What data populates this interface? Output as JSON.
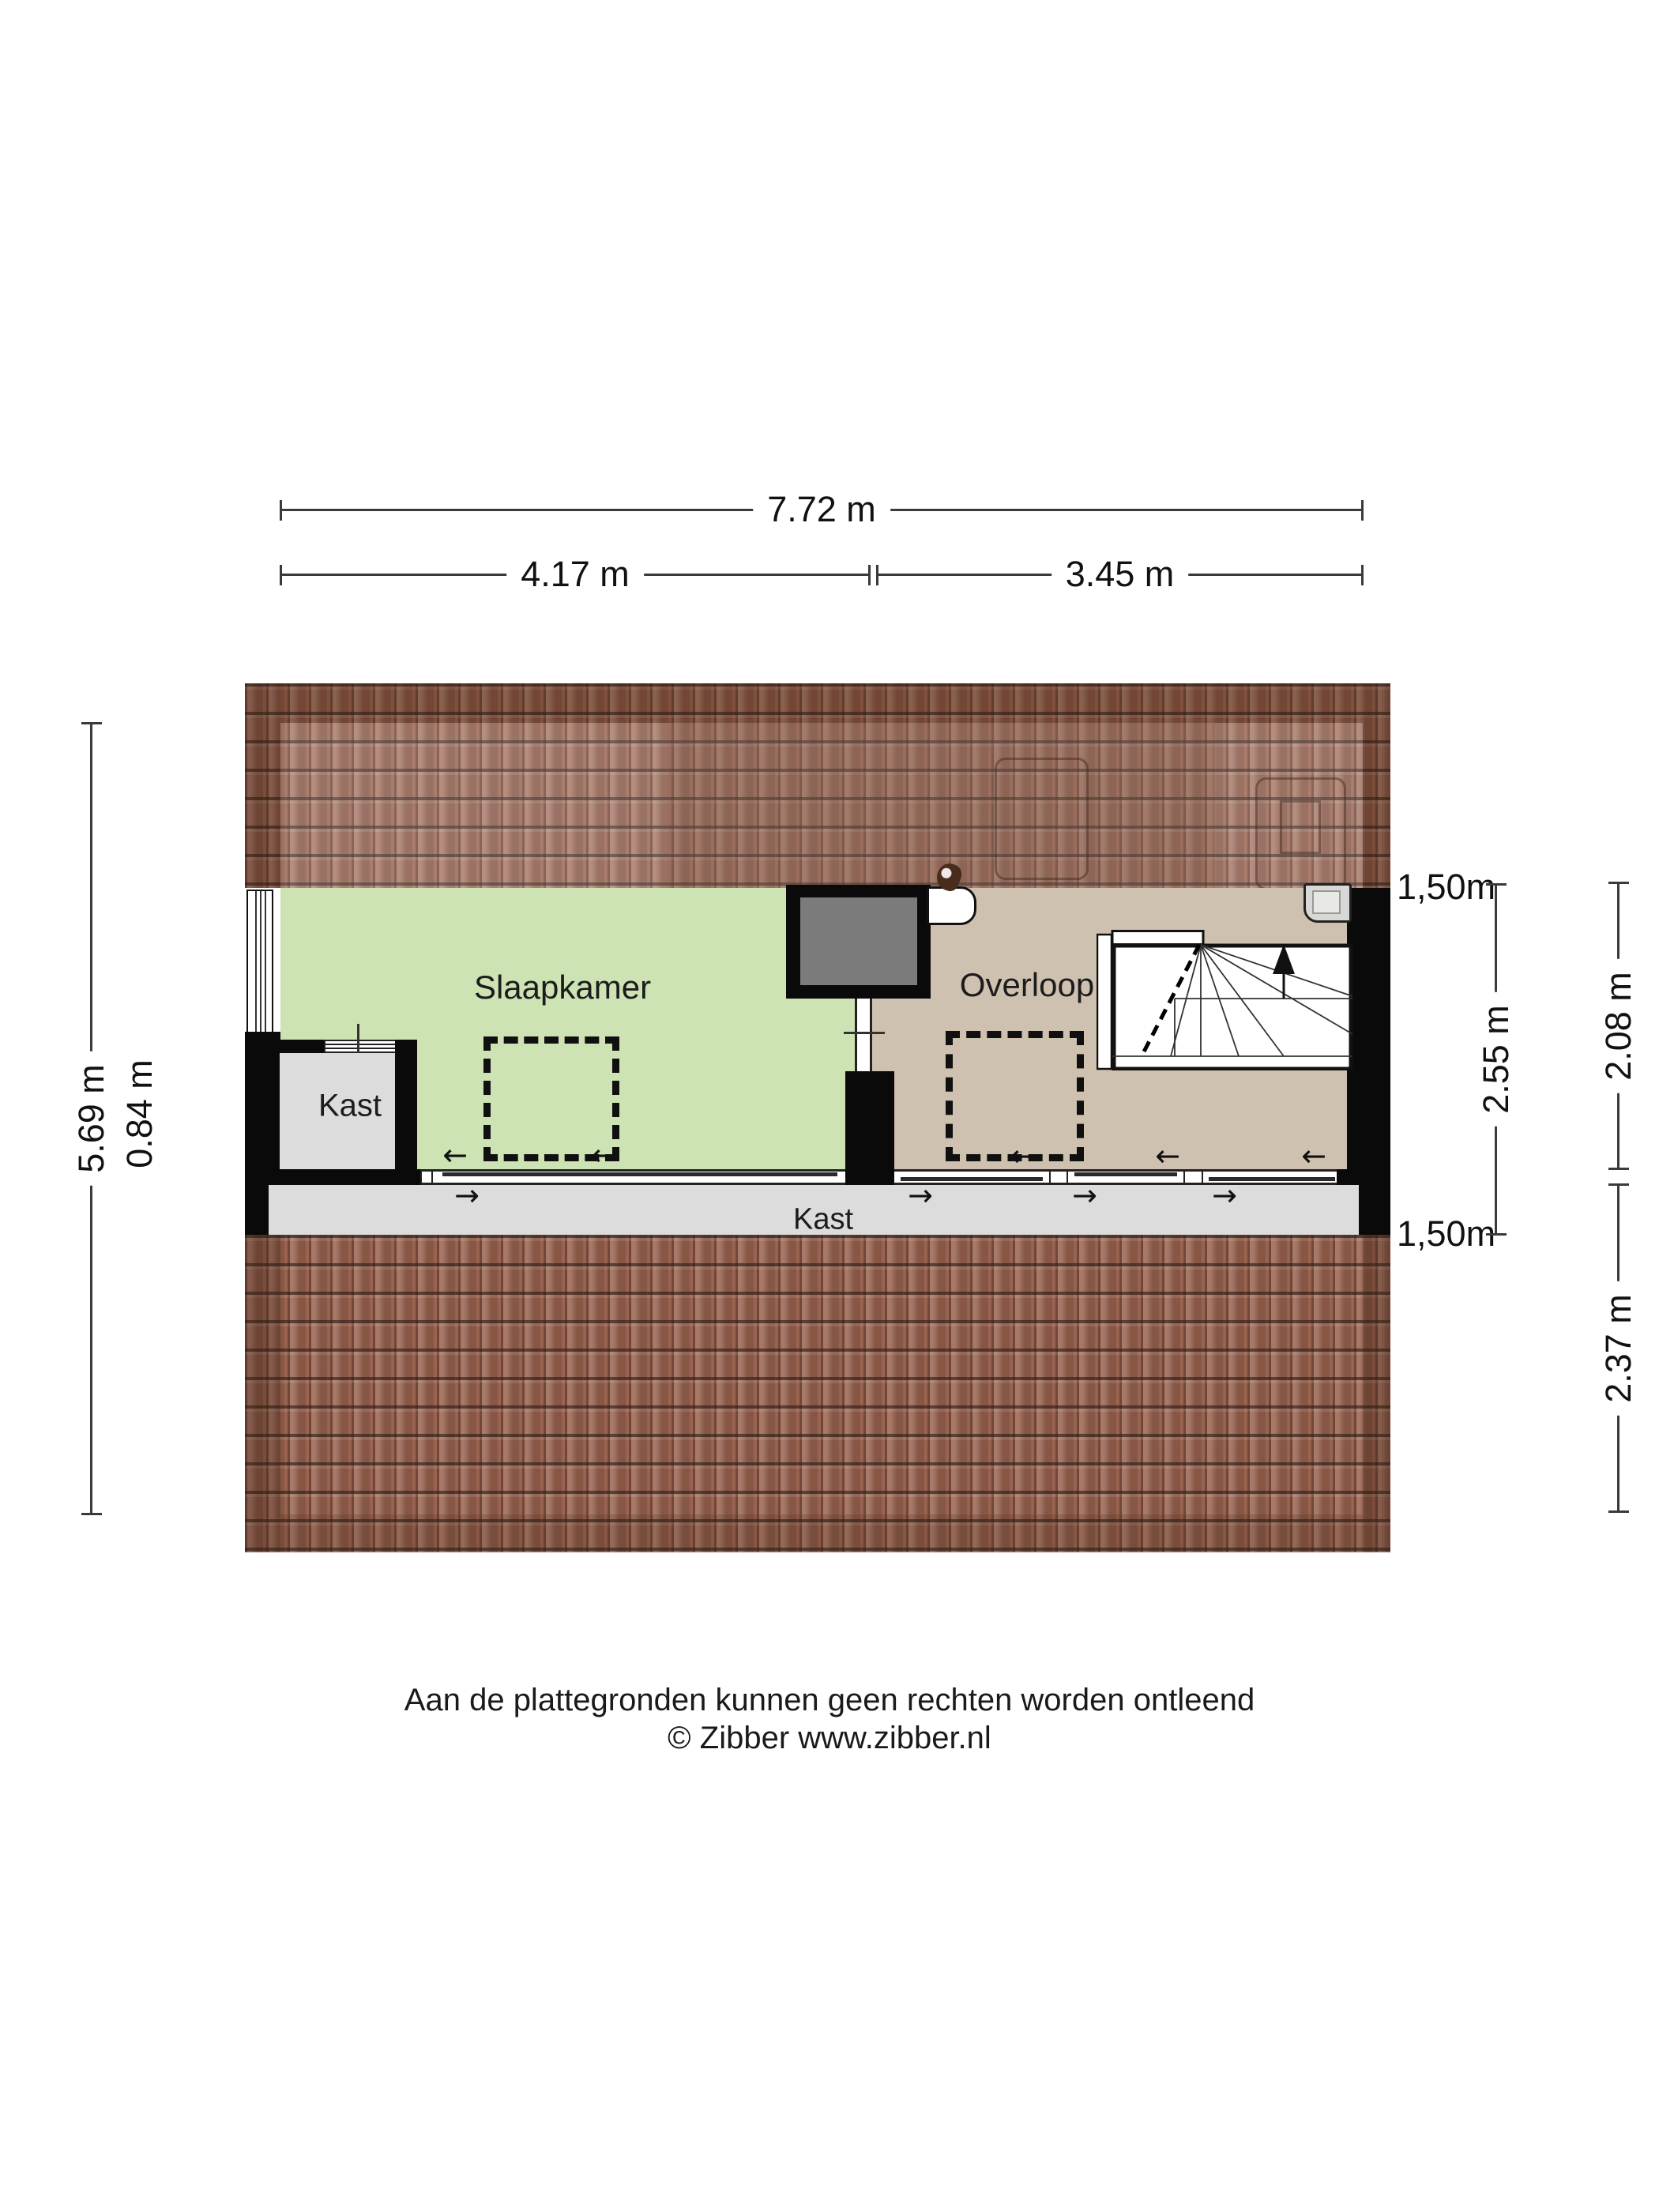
{
  "title": "Zibber plattegrond - verdieping (zolder)",
  "dimensions": {
    "top_total": "7.72 m",
    "top_left": "4.17 m",
    "top_right": "3.45 m",
    "left_total": "5.69 m",
    "left_kast": "0.84 m",
    "right_height_top": "1,50m",
    "right_room_depth": "2.55 m",
    "right_overloop_depth": "2.08 m",
    "right_height_bottom": "1,50m",
    "right_storage_depth": "2.37 m"
  },
  "rooms": {
    "slaapkamer": {
      "label": "Slaapkamer"
    },
    "overloop": {
      "label": "Overloop"
    },
    "kast_closet": {
      "label": "Kast"
    },
    "kast_storage": {
      "label": "Kast"
    }
  },
  "icons": {
    "arrow_left": "←",
    "arrow_right": "→",
    "stairs_up_arrow": "up-arrow"
  },
  "footer": {
    "line1": "Aan de plattegronden kunnen geen rechten worden ontleend",
    "line2": "© Zibber www.zibber.nl"
  },
  "colors": {
    "green": "#cde3b4",
    "beige": "#cfc1af",
    "floor_gray": "#dcdcdc",
    "tile_base": "#9a6350",
    "wall_black": "#0a0a0a",
    "chimney_gray": "#7b7b7b",
    "dim_line": "#3a3a3a"
  }
}
